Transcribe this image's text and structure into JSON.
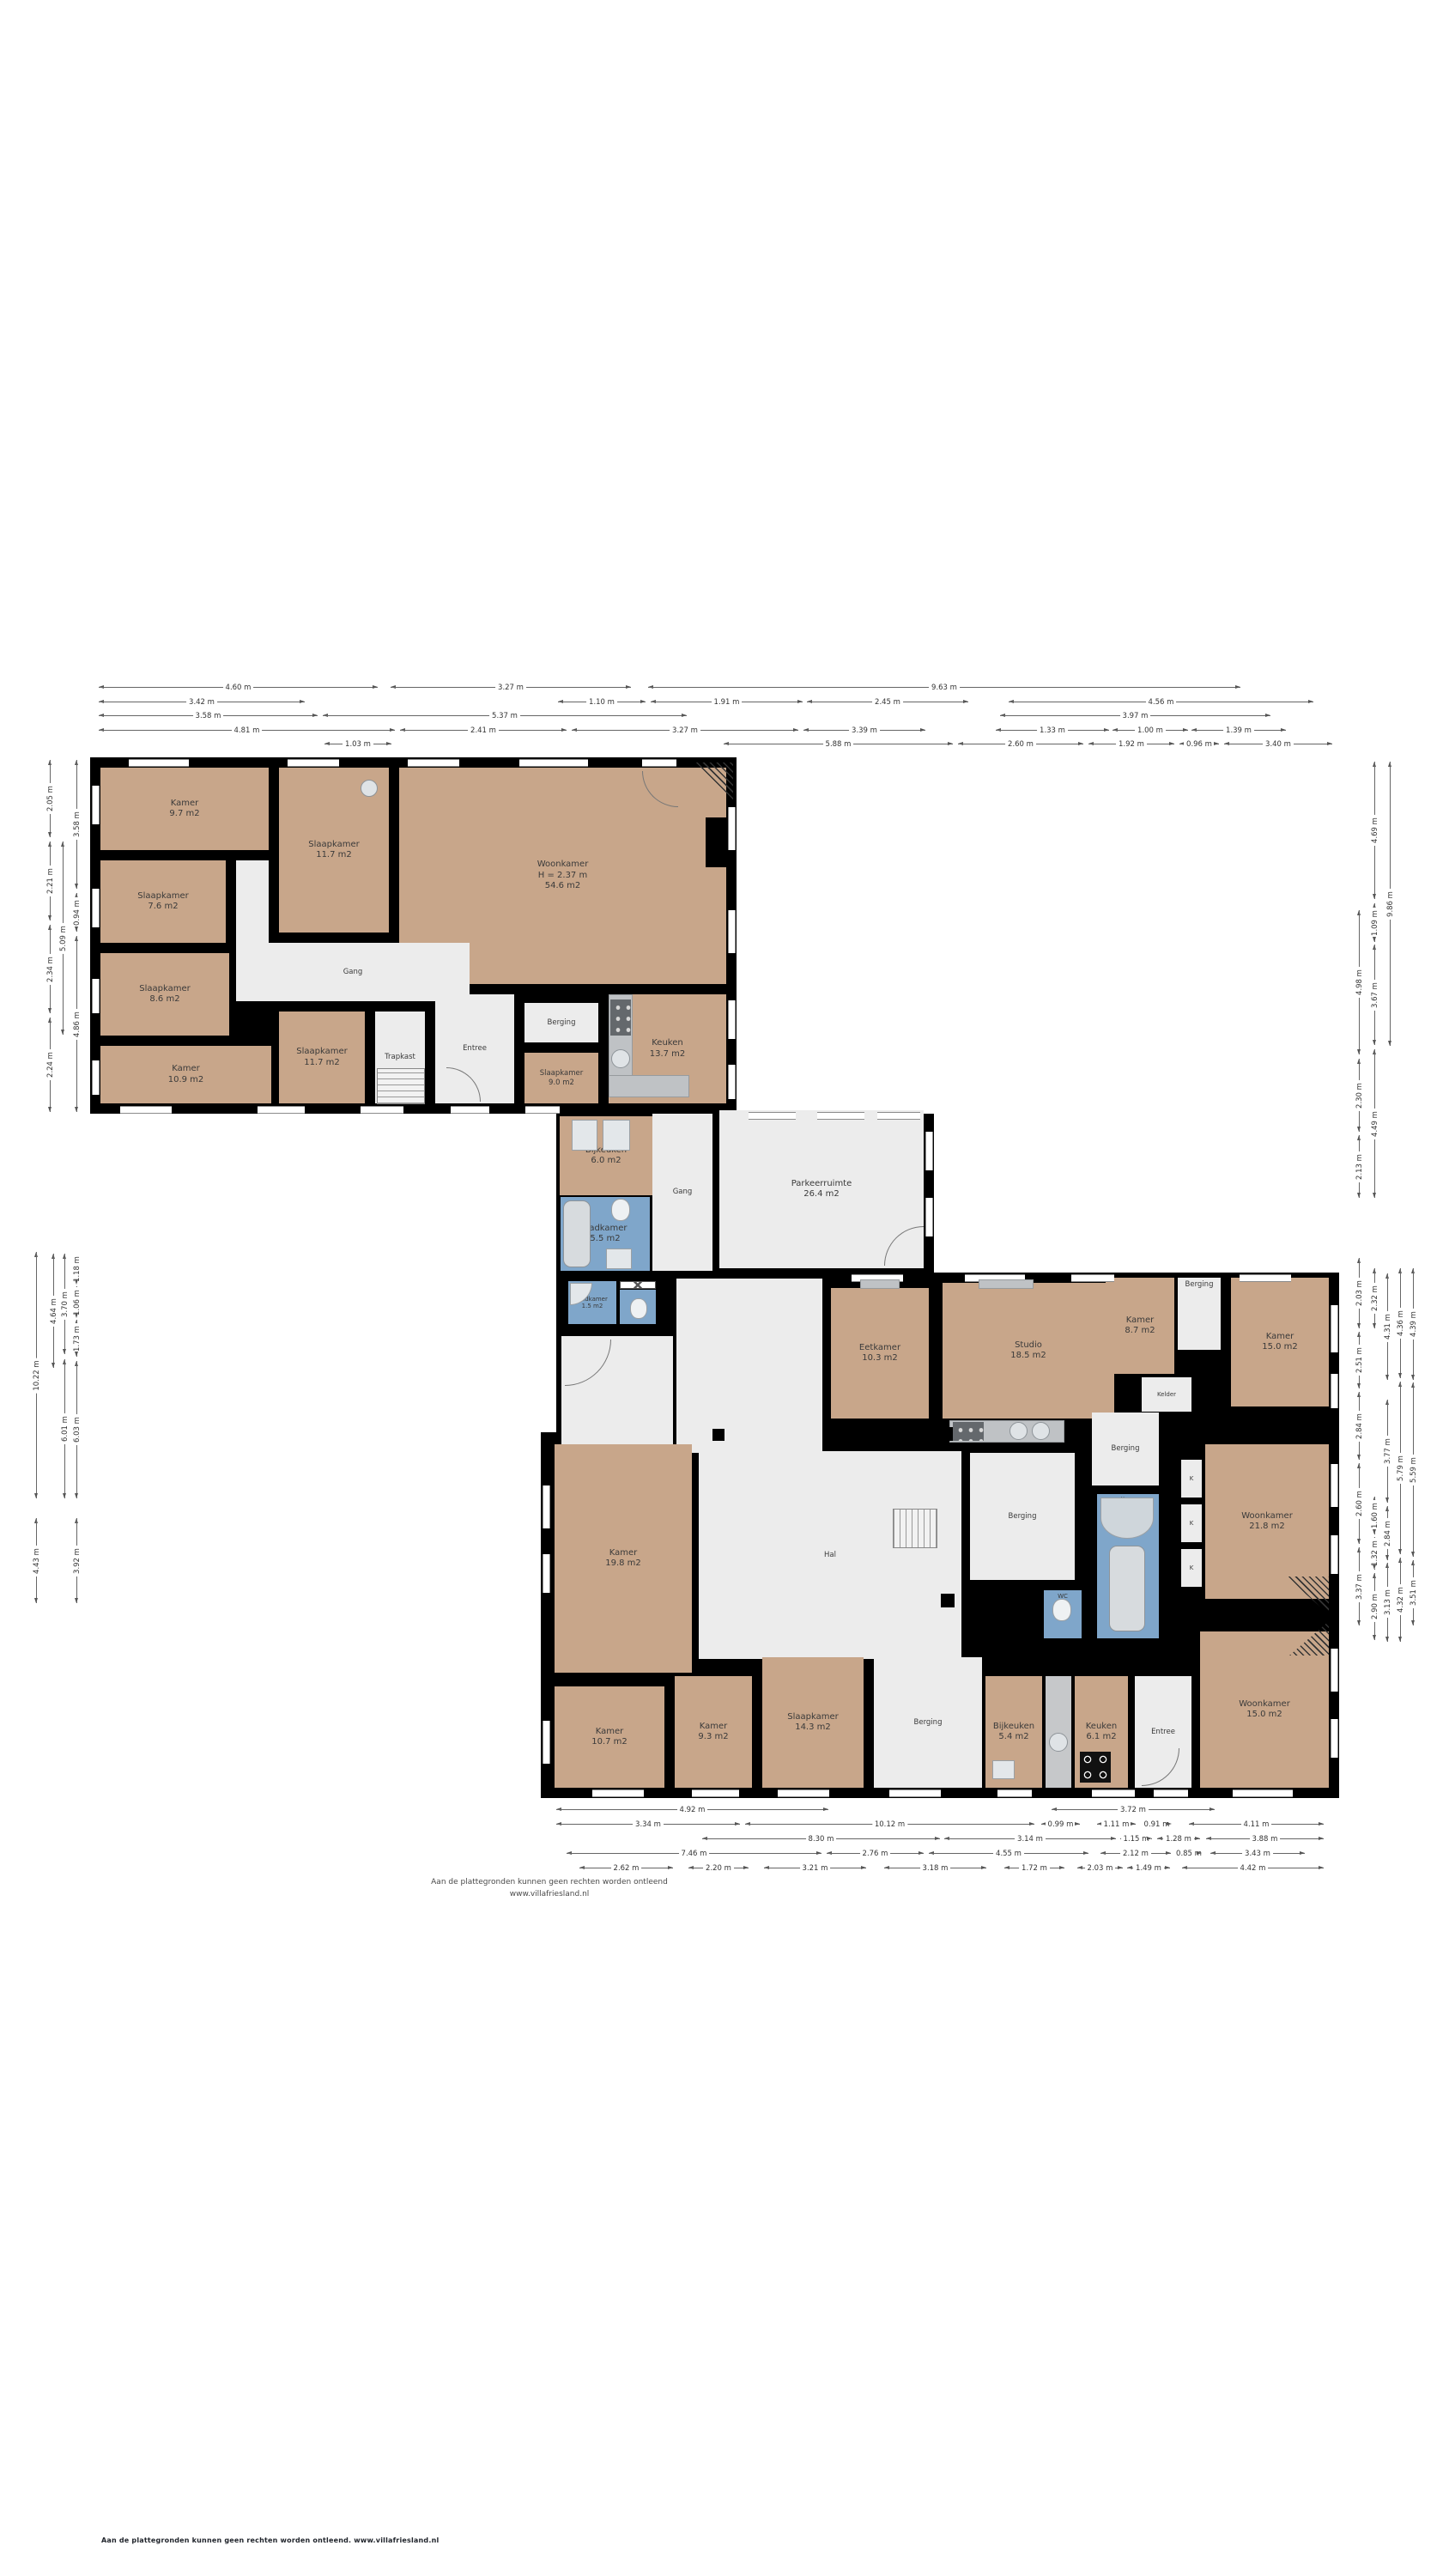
{
  "page": {
    "background": "#ffffff"
  },
  "colors": {
    "room_tan": "#c8a68a",
    "wet_room_blue": "#7fa6ca",
    "floor_light": "#ececec",
    "wall_black": "#000000",
    "counter_gray": "#bfc2c5"
  },
  "footer": {
    "center_line1": "Aan de plattegronden kunnen geen rechten worden ontleend",
    "center_line2": "www.villafriesland.nl",
    "bottom_text": "Aan de plattegronden kunnen geen rechten worden ontleend. www.villafriesland.nl"
  },
  "floorplan": {
    "rooms": [
      {
        "id": "kamer97",
        "label": "Kamer",
        "area": "9.7 m2"
      },
      {
        "id": "slaapkamer117a",
        "label": "Slaapkamer",
        "area": "11.7 m2"
      },
      {
        "id": "woonkamer546",
        "label": "Woonkamer",
        "note": "H = 2.37 m",
        "area": "54.6 m2"
      },
      {
        "id": "slaapkamer76",
        "label": "Slaapkamer",
        "area": "7.6 m2"
      },
      {
        "id": "gang1",
        "label": "Gang"
      },
      {
        "id": "slaapkamer86",
        "label": "Slaapkamer",
        "area": "8.6 m2"
      },
      {
        "id": "kamer109",
        "label": "Kamer",
        "area": "10.9 m2"
      },
      {
        "id": "slaapkamer117b",
        "label": "Slaapkamer",
        "area": "11.7 m2"
      },
      {
        "id": "trapkast",
        "label": "Trapkast"
      },
      {
        "id": "entree1",
        "label": "Entree"
      },
      {
        "id": "berging1",
        "label": "Berging"
      },
      {
        "id": "slaapkamer90",
        "label": "Slaapkamer",
        "area": "9.0 m2"
      },
      {
        "id": "keuken137",
        "label": "Keuken",
        "area": "13.7 m2"
      },
      {
        "id": "bijkeuken60",
        "label": "Bijkeuken",
        "area": "6.0 m2"
      },
      {
        "id": "badkamer55",
        "label": "Badkamer",
        "area": "5.5 m2"
      },
      {
        "id": "badkamer15",
        "label": "Badkamer",
        "area": "1.5 m2"
      },
      {
        "id": "wc1",
        "label": "WC"
      },
      {
        "id": "gang2",
        "label": "Gang"
      },
      {
        "id": "parkeerruimte",
        "label": "Parkeerruimte",
        "area": "26.4 m2"
      },
      {
        "id": "hal",
        "label": "Hal"
      },
      {
        "id": "eetkamer",
        "label": "Eetkamer",
        "area": "10.3 m2"
      },
      {
        "id": "studio",
        "label": "Studio",
        "area": "18.5 m2"
      },
      {
        "id": "kamer87",
        "label": "Kamer",
        "area": "8.7 m2"
      },
      {
        "id": "kelder",
        "label": "Kelder"
      },
      {
        "id": "bergingTop",
        "label": "Berging"
      },
      {
        "id": "kamer150",
        "label": "Kamer",
        "area": "15.0 m2"
      },
      {
        "id": "bergingBig",
        "label": "Berging"
      },
      {
        "id": "bergingNarrow",
        "label": "Berging"
      },
      {
        "id": "badkamer32",
        "label": "Badkamer",
        "area": "3.2 m2"
      },
      {
        "id": "wc2",
        "label": "WC"
      },
      {
        "id": "woonkamer218",
        "label": "Woonkamer",
        "area": "21.8 m2"
      },
      {
        "id": "k1",
        "label": "K"
      },
      {
        "id": "k2",
        "label": "K"
      },
      {
        "id": "k3",
        "label": "K"
      },
      {
        "id": "woonkamer150",
        "label": "Woonkamer",
        "area": "15.0 m2"
      },
      {
        "id": "kamer198",
        "label": "Kamer",
        "area": "19.8 m2"
      },
      {
        "id": "kamer107",
        "label": "Kamer",
        "area": "10.7 m2"
      },
      {
        "id": "kamer93",
        "label": "Kamer",
        "area": "9.3 m2"
      },
      {
        "id": "slaapkamer143",
        "label": "Slaapkamer",
        "area": "14.3 m2"
      },
      {
        "id": "bergingBot",
        "label": "Berging"
      },
      {
        "id": "bijkeuken54",
        "label": "Bijkeuken",
        "area": "5.4 m2"
      },
      {
        "id": "keuken61",
        "label": "Keuken",
        "area": "6.1 m2"
      },
      {
        "id": "entree2",
        "label": "Entree"
      }
    ],
    "dimensions": {
      "top_rows": [
        [
          "4.60 m",
          "3.27 m",
          "9.63 m"
        ],
        [
          "3.42 m",
          "1.10 m",
          "1.91 m",
          "2.45 m",
          "4.56 m"
        ],
        [
          "3.58 m",
          "5.37 m",
          "3.97 m"
        ],
        [
          "4.81 m",
          "2.41 m",
          "3.27 m",
          "3.39 m",
          "1.33 m",
          "1.00 m",
          "1.39 m"
        ],
        [
          "1.03 m",
          "5.88 m",
          "2.60 m",
          "1.92 m",
          "0.96 m",
          "3.40 m"
        ]
      ],
      "bottom_rows": [
        [
          "4.92 m",
          "3.72 m"
        ],
        [
          "3.34 m",
          "10.12 m",
          "0.99 m",
          "1.11 m",
          "0.91 m",
          "4.11 m"
        ],
        [
          "8.30 m",
          "3.14 m",
          "1.15 m",
          "1.28 m",
          "3.88 m"
        ],
        [
          "7.46 m",
          "2.76 m",
          "4.55 m",
          "2.12 m",
          "0.85 m",
          "3.43 m"
        ],
        [
          "2.62 m",
          "2.20 m",
          "3.21 m",
          "3.18 m",
          "1.72 m",
          "2.03 m",
          "1.49 m",
          "4.42 m"
        ]
      ],
      "left_upper": [
        [
          "2.05 m",
          "2.21 m",
          "2.34 m",
          "2.24 m"
        ],
        [
          "5.09 m"
        ],
        [
          "3.58 m",
          "0.94 m",
          "4.86 m"
        ]
      ],
      "left_lower": [
        [
          "10.22 m",
          "4.43 m"
        ],
        [
          "4.64 m"
        ],
        [
          "3.70 m",
          "6.01 m"
        ],
        [
          "1.18 m",
          "1.06 m",
          "1.73 m",
          "6.03 m",
          "3.92 m"
        ]
      ],
      "right_upper": [
        [
          "4.98 m",
          "2.30 m",
          "2.13 m"
        ],
        [
          "4.69 m",
          "1.09 m",
          "3.67 m",
          "4.49 m"
        ],
        [
          "9.86 m"
        ]
      ],
      "right_lower": [
        [
          "2.03 m",
          "2.51 m",
          "2.84 m",
          "2.60 m",
          "3.37 m"
        ],
        [
          "2.32 m",
          "1.60 m",
          "1.32 m",
          "2.90 m"
        ],
        [
          "4.31 m",
          "3.77 m",
          "2.84 m",
          "3.13 m"
        ],
        [
          "4.36 m",
          "5.79 m",
          "4.32 m"
        ],
        [
          "4.39 m",
          "5.59 m",
          "3.51 m"
        ]
      ]
    }
  }
}
